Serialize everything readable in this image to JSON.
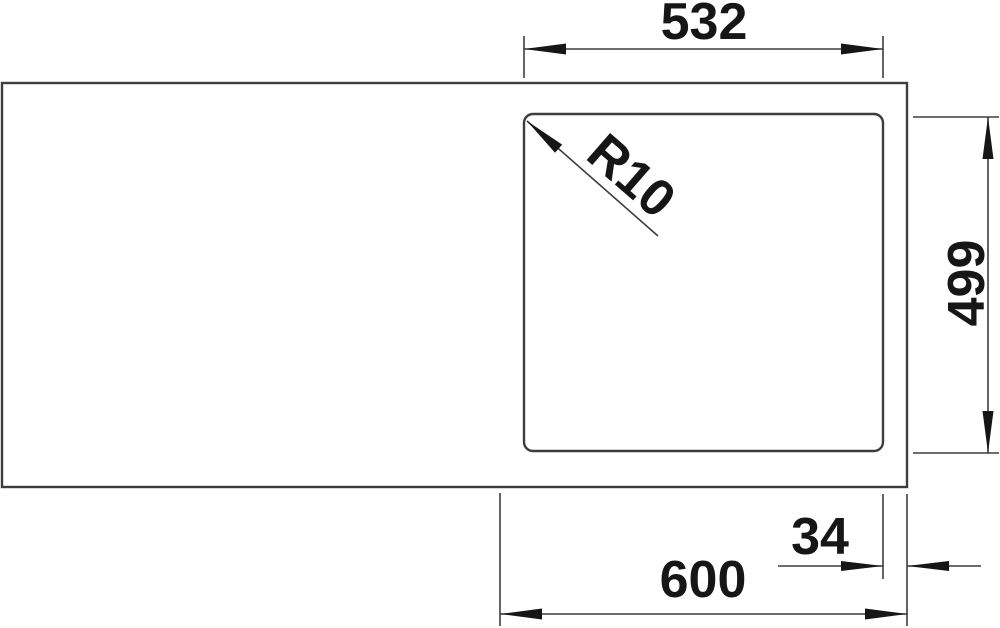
{
  "colors": {
    "background": "#ffffff",
    "line": "#3d3d3d",
    "ink": "#161616"
  },
  "drawing": {
    "labels": {
      "bowl_width": "532",
      "corner_radius": "R10",
      "bowl_depth": "499",
      "right_offset": "34",
      "cabinet_width": "600"
    }
  }
}
